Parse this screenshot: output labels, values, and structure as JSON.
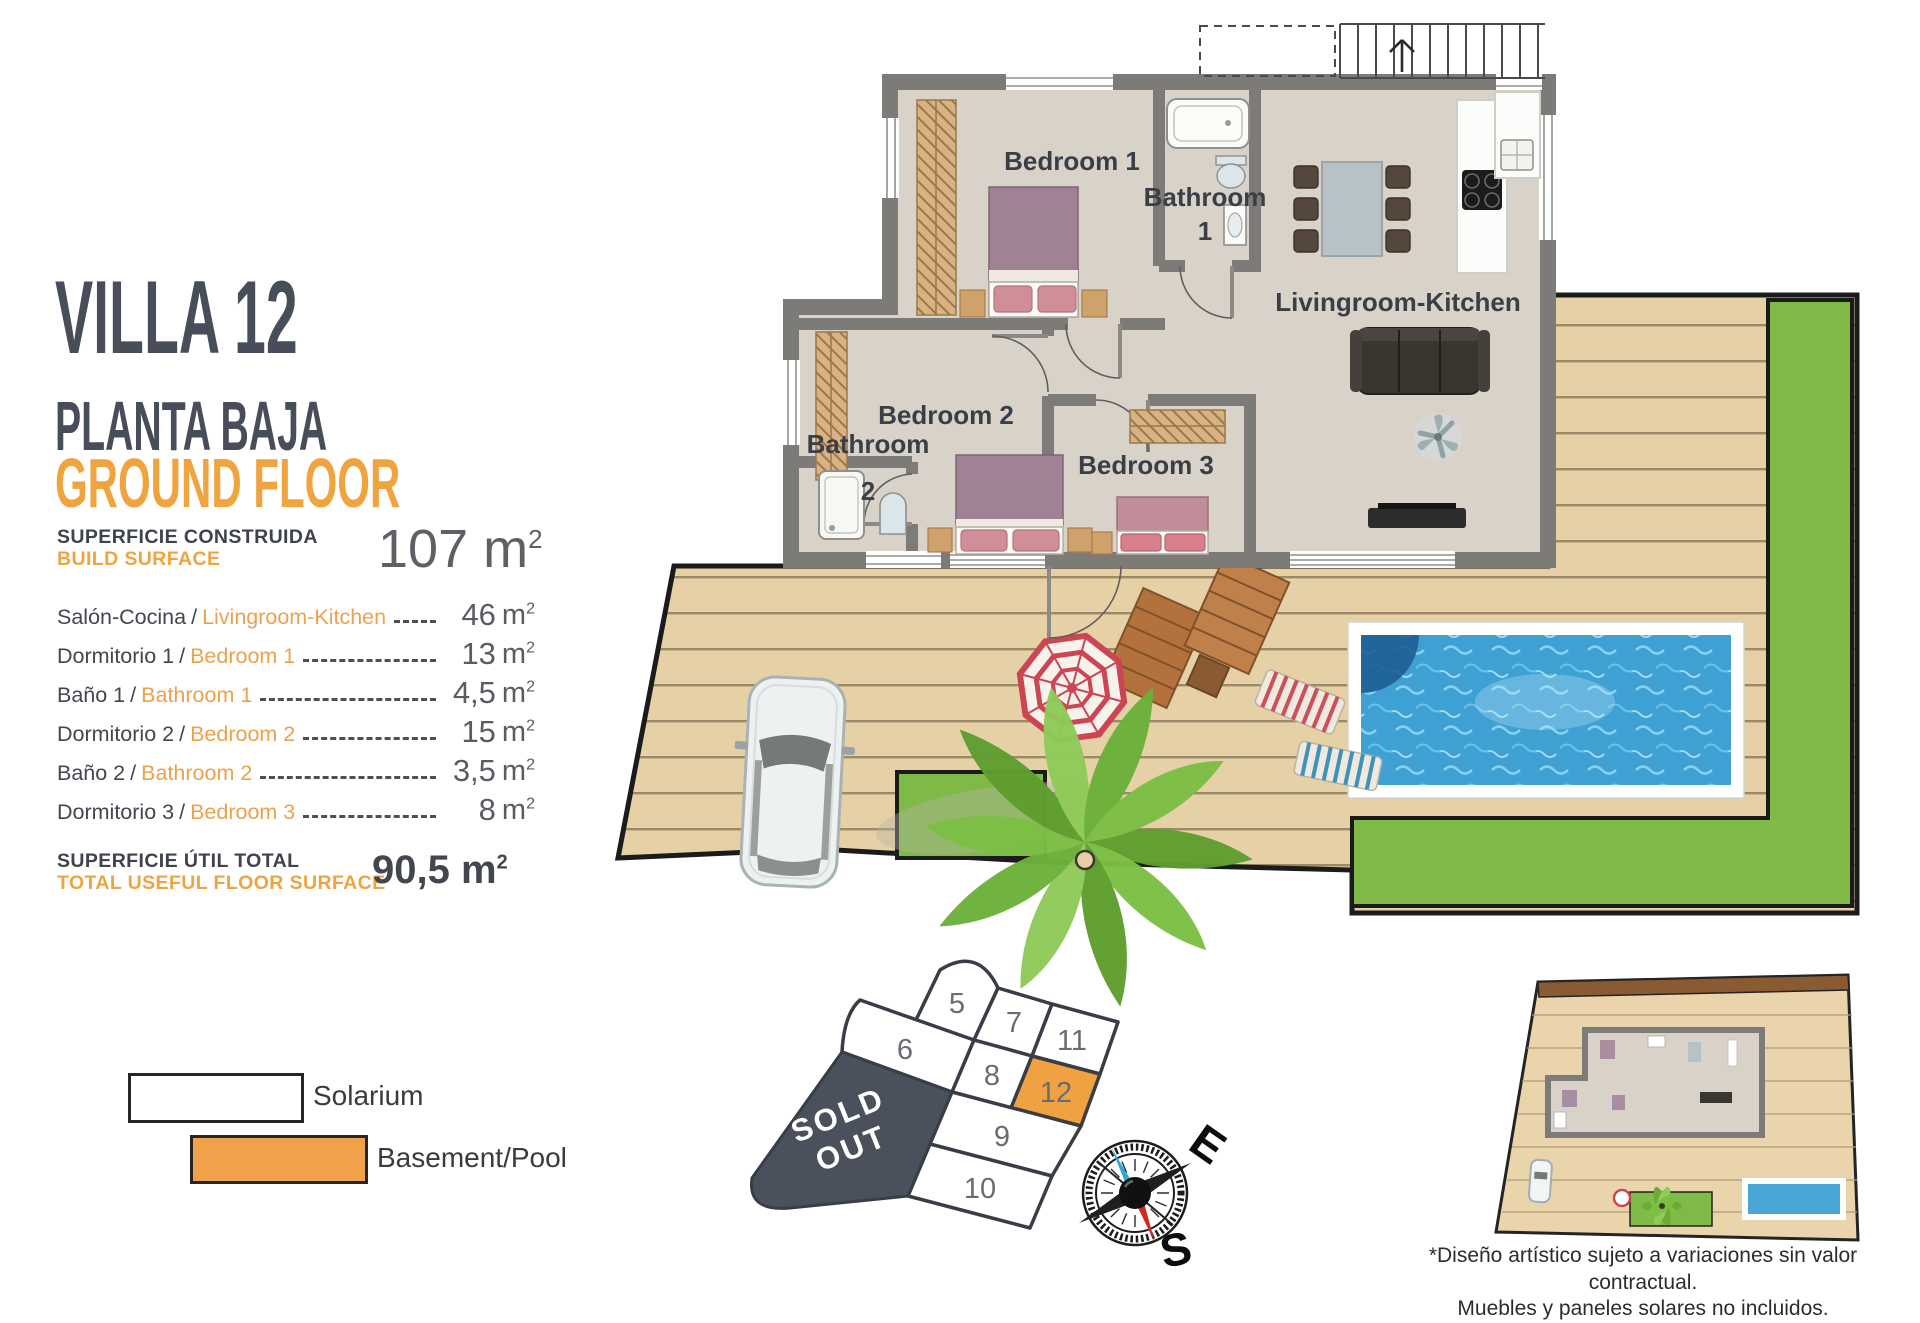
{
  "header": {
    "title": "VILLA 12",
    "subtitle_es": "PLANTA BAJA",
    "subtitle_en": "GROUND FLOOR"
  },
  "build_surface": {
    "label_es": "SUPERFICIE CONSTRUIDA",
    "label_en": "BUILD SURFACE",
    "value": "107",
    "unit": "m",
    "unit_exp": "2"
  },
  "surface_table": {
    "separator": "/",
    "unit": "m",
    "unit_exp": "2",
    "rows": [
      {
        "es": "Salón-Cocina",
        "en": "Livingroom-Kitchen",
        "value": "46"
      },
      {
        "es": "Dormitorio 1",
        "en": "Bedroom 1",
        "value": "13"
      },
      {
        "es": "Baño 1",
        "en": "Bathroom 1",
        "value": "4,5"
      },
      {
        "es": "Dormitorio 2",
        "en": "Bedroom 2",
        "value": "15"
      },
      {
        "es": "Baño 2",
        "en": "Bathroom 2",
        "value": "3,5"
      },
      {
        "es": "Dormitorio 3",
        "en": "Bedroom 3",
        "value": "8"
      }
    ]
  },
  "total": {
    "label_es": "SUPERFICIE ÚTIL TOTAL",
    "label_en": "TOTAL USEFUL FLOOR SURFACE",
    "value": "90,5",
    "unit": "m",
    "unit_exp": "2"
  },
  "legend": {
    "solarium": "Solarium",
    "basement": "Basement/Pool"
  },
  "floor_plan": {
    "labels": {
      "bedroom1": "Bedroom 1",
      "bathroom1_l1": "Bathroom",
      "bathroom1_l2": "1",
      "bedroom2": "Bedroom 2",
      "bedroom3": "Bedroom 3",
      "bathroom2_l1": "Bathroom",
      "bathroom2_l2": "2",
      "livingroom": "Livingroom-Kitchen"
    }
  },
  "plot_map": {
    "sold_line1": "SOLD",
    "sold_line2": "OUT",
    "highlighted_plot": "12",
    "plots": {
      "p5": "5",
      "p6": "6",
      "p7": "7",
      "p8": "8",
      "p9": "9",
      "p10": "10",
      "p11": "11",
      "p12": "12"
    }
  },
  "compass": {
    "east": "E",
    "south": "S"
  },
  "disclaimer": {
    "line1": "*Diseño artístico sujeto a variaciones sin valor contractual.",
    "line2": "Muebles y paneles solares no incluidos."
  },
  "colors": {
    "accent_orange": "#F0A440",
    "heading_slate": "#474D59",
    "sold_out_bg": "#4A505C",
    "plot_highlight": "#F0A243",
    "lawn_green": "#7FBA49",
    "pool_blue": "#3FA0D4",
    "deck_tan": "#E6D0A6",
    "wall_gray": "#7C7B77"
  }
}
